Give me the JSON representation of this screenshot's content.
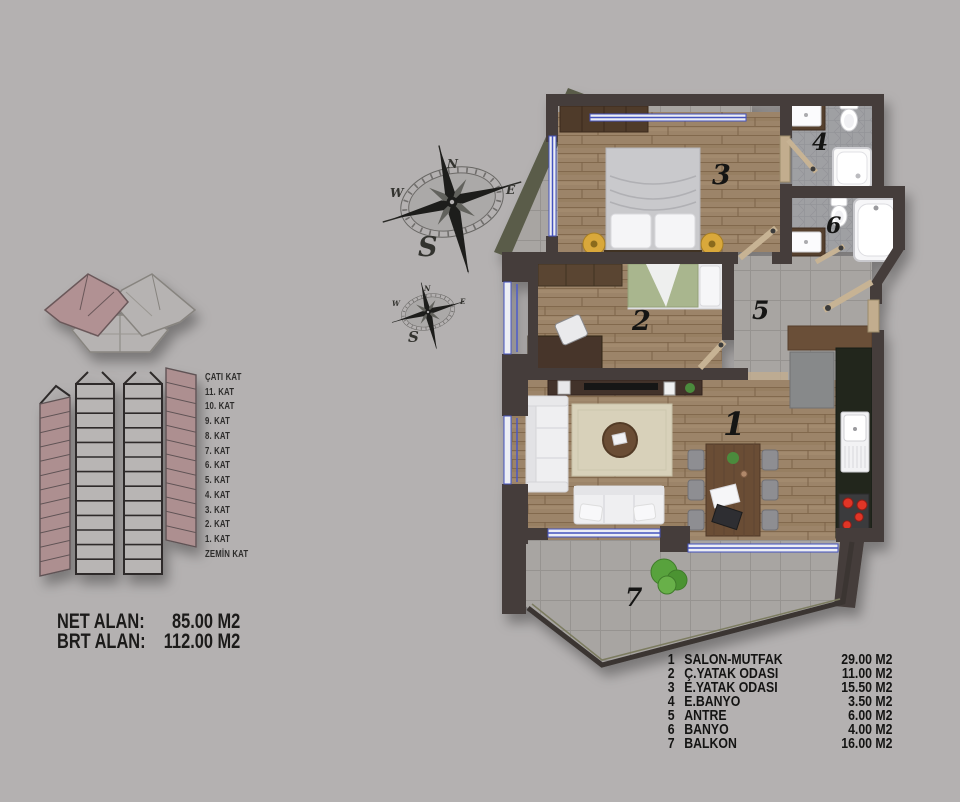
{
  "areas": {
    "net_label": "NET ALAN:",
    "net_value": "85.00 M2",
    "brt_label": "BRT ALAN:",
    "brt_value": "112.00 M2"
  },
  "elevation_floors": [
    "ÇATI KAT",
    "11. KAT",
    "10. KAT",
    "9. KAT",
    "8. KAT",
    "7. KAT",
    "6. KAT",
    "5. KAT",
    "4. KAT",
    "3. KAT",
    "2. KAT",
    "1. KAT",
    "ZEMİN KAT"
  ],
  "compass": {
    "n": "N",
    "e": "E",
    "w": "W",
    "s": "S"
  },
  "rooms": [
    {
      "no": "1",
      "name": "SALON-MUTFAK",
      "area": "29.00 M2"
    },
    {
      "no": "2",
      "name": "Ç.YATAK ODASI",
      "area": "11.00 M2"
    },
    {
      "no": "3",
      "name": "E.YATAK ODASI",
      "area": "15.50 M2"
    },
    {
      "no": "4",
      "name": "E.BANYO",
      "area": "3.50 M2"
    },
    {
      "no": "5",
      "name": "ANTRE",
      "area": "6.00 M2"
    },
    {
      "no": "6",
      "name": "BANYO",
      "area": "4.00 M2"
    },
    {
      "no": "7",
      "name": "BALKON",
      "area": "16.00 M2"
    }
  ],
  "colors": {
    "background": "#b4b1b1",
    "wall": "#453d3b",
    "wood_floor": "#9c8469",
    "tile_floor": "#a8a5a2",
    "window_blue": "#4a58c4",
    "building_pink": "#ad8f90",
    "counter_dark": "#20261e",
    "burner_red": "#e03428"
  }
}
